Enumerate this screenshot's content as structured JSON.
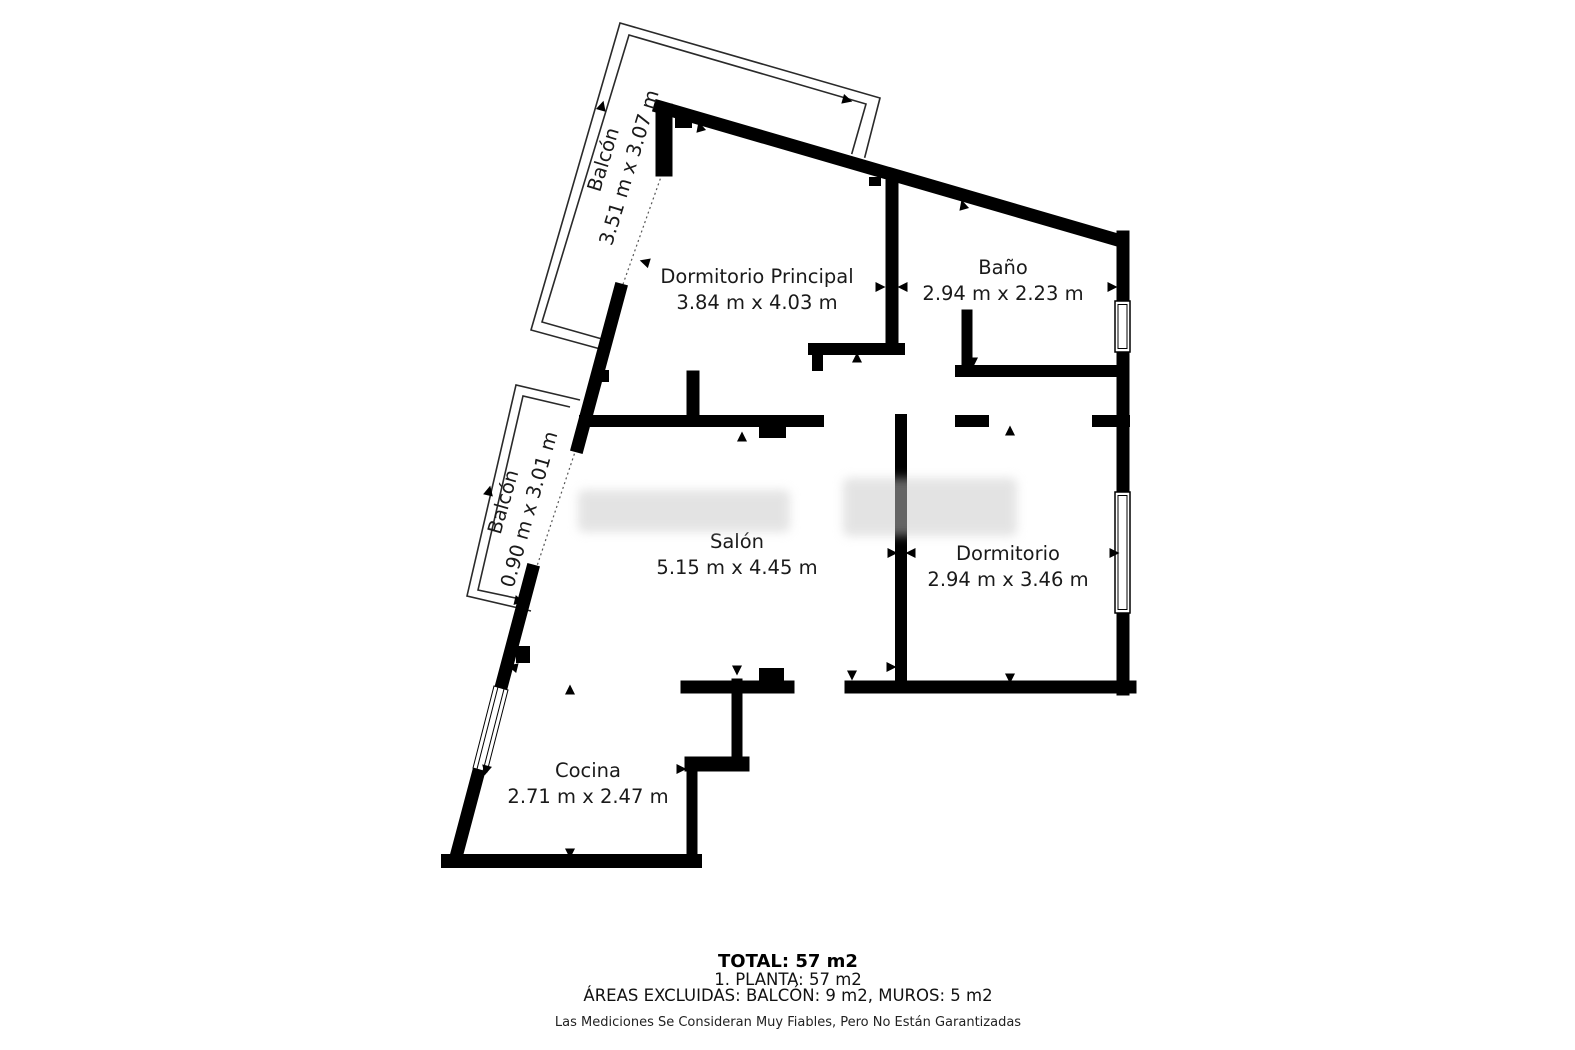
{
  "page": {
    "background": "#ffffff"
  },
  "watermark": {
    "color": "#c9c9c9",
    "opacity": 0.5
  },
  "rooms": [
    {
      "name": "Dormitorio Principal",
      "dims": "3.84 m x 4.03 m",
      "lx": 757,
      "ly1": 283,
      "ly2": 309
    },
    {
      "name": "Baño",
      "dims": "2.94 m x 2.23 m",
      "lx": 1003,
      "ly1": 274,
      "ly2": 300
    },
    {
      "name": "Salón",
      "dims": "5.15 m x 4.45 m",
      "lx": 737,
      "ly1": 548,
      "ly2": 574
    },
    {
      "name": "Dormitorio",
      "dims": "2.94 m x 3.46 m",
      "lx": 1008,
      "ly1": 560,
      "ly2": 586
    },
    {
      "name": "Cocina",
      "dims": "2.71 m x 2.47 m",
      "lx": 588,
      "ly1": 777,
      "ly2": 803
    }
  ],
  "balconies": [
    {
      "name": "Balcón",
      "dims": "3.51 m x 3.07 m",
      "transform": "translate(621,165) rotate(-73)"
    },
    {
      "name": "Balcón",
      "dims": "0.90 m x 3.01 m",
      "transform": "translate(521,507) rotate(-74)"
    }
  ],
  "footer": {
    "total": "TOTAL: 57 m2",
    "planta": "1. PLANTA: 57 m2",
    "excluded": "ÁREAS EXCLUIDAS: BALCÓN: 9 m2, MUROS: 5 m2",
    "disclaimer": "Las Mediciones Se Consideran Muy Fiables, Pero No Están Garantizadas"
  },
  "floorplan": {
    "wall_color": "#000000",
    "railing_color": "#2a2a2a",
    "balcony_outlines": [
      "862,168 880,98 620,23 531,330 604,350",
      "850,160 866,104 629,35 542,322 602,339",
      "580,400 516,385 467,596 531,611",
      "570,407 523,396 478,590 525,600"
    ],
    "cover_polygon": "664,100 893,166 800,425 601,352 622,286",
    "dashed_lines": [
      [
        662,
        174,
        622,
        287
      ],
      [
        576,
        449,
        536,
        569
      ]
    ],
    "walls": [
      [
        660,
        107,
        1121,
        241,
        13
      ],
      [
        1123,
        237,
        1123,
        689,
        13
      ],
      [
        1130,
        687,
        851,
        687,
        13
      ],
      [
        788,
        687,
        687,
        687,
        13
      ],
      [
        737,
        684,
        737,
        764,
        11
      ],
      [
        742,
        764,
        692,
        764,
        15
      ],
      [
        692,
        766,
        692,
        856,
        11
      ],
      [
        695,
        861,
        448,
        861,
        14
      ],
      [
        456,
        857,
        532,
        571,
        13
      ],
      [
        578,
        446,
        620,
        290,
        13
      ],
      [
        664,
        112,
        664,
        168,
        17
      ],
      [
        892,
        186,
        892,
        342,
        13
      ],
      [
        814,
        349,
        899,
        349,
        12
      ],
      [
        967,
        315,
        967,
        369,
        11
      ],
      [
        961,
        371,
        1121,
        371,
        12
      ],
      [
        585,
        421,
        818,
        421,
        12
      ],
      [
        693,
        377,
        693,
        419,
        13
      ],
      [
        901,
        420,
        901,
        687,
        12
      ],
      [
        961,
        421,
        983,
        421,
        12
      ],
      [
        1098,
        421,
        1124,
        421,
        12
      ]
    ],
    "wall_rects": [
      [
        759,
        668,
        25,
        14
      ],
      [
        759,
        427,
        27,
        11
      ],
      [
        597,
        370,
        12,
        12
      ],
      [
        516,
        646,
        14,
        17
      ],
      [
        675,
        118,
        17,
        10
      ],
      [
        812,
        349,
        11,
        22
      ],
      [
        869,
        177,
        12,
        9
      ]
    ],
    "windows": [
      [
        1115,
        301,
        15,
        51
      ],
      [
        1115,
        492,
        15,
        121
      ]
    ],
    "window_diagonal": {
      "outer": "508,690 494,686 473,768 487,772",
      "lines": [
        [
          504,
          689,
          483,
          771
        ],
        [
          498,
          687,
          477,
          769
        ]
      ]
    },
    "arrows": [
      [
        602,
        106,
        16
      ],
      [
        847,
        100,
        106
      ],
      [
        489,
        491,
        13
      ],
      [
        519,
        601,
        103
      ],
      [
        606,
        339,
        106
      ],
      [
        700,
        127,
        -16
      ],
      [
        857,
        358,
        0
      ],
      [
        645,
        262,
        -73
      ],
      [
        880,
        287,
        90
      ],
      [
        963,
        205,
        -16
      ],
      [
        973,
        362,
        180
      ],
      [
        903,
        287,
        -90
      ],
      [
        1112,
        287,
        90
      ],
      [
        742,
        437,
        0
      ],
      [
        737,
        670,
        180
      ],
      [
        513,
        667,
        -76
      ],
      [
        892,
        553,
        90
      ],
      [
        1010,
        431,
        0
      ],
      [
        1010,
        678,
        180
      ],
      [
        911,
        553,
        -90
      ],
      [
        1114,
        553,
        90
      ],
      [
        570,
        690,
        0
      ],
      [
        570,
        853,
        180
      ],
      [
        486,
        770,
        -166
      ],
      [
        681,
        769,
        90
      ],
      [
        852,
        675,
        180
      ],
      [
        891,
        667,
        90
      ]
    ]
  }
}
